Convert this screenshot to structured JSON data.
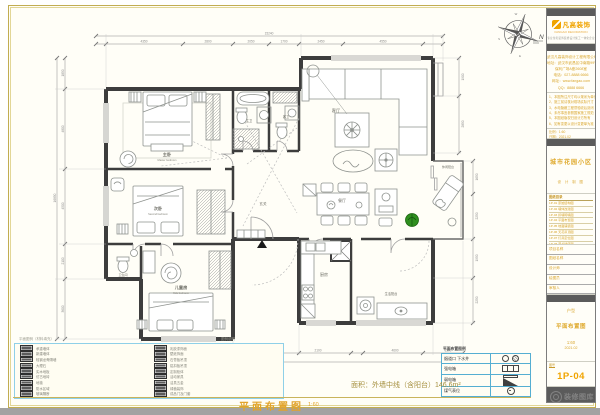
{
  "footer": {
    "title": "平面布置图",
    "scale": "1:60",
    "area": "面积：外墙中线（含阳台）146.6m²"
  },
  "north": "N",
  "compass_letters": {
    "top": "W",
    "left": "S",
    "bottom": "E"
  },
  "rooms": {
    "master_zh": "主卧",
    "master_en": "Master bedroom",
    "second_zh": "次卧",
    "second_en": "Second bedroom",
    "kids_zh": "儿童房",
    "kids_en": "Kids bedroom",
    "living": "客厅",
    "dining": "餐厅",
    "kitchen": "厨房",
    "hall": "玄关",
    "bath1": "主卫",
    "bath2": "客卫",
    "bath3": "卫生间",
    "laundry": "生活阳台",
    "balcony": "休闲阳台"
  },
  "dims": {
    "top": [
      "4350",
      "2800",
      "2050",
      "1700",
      "2450",
      "4550"
    ],
    "top_total": "15240",
    "left": [
      "1850",
      "4800",
      "4500",
      "2100",
      "3600"
    ],
    "left_total": "16850",
    "bottom": [
      "2250",
      "3600",
      "2500",
      "2100",
      "4600",
      "1500"
    ],
    "bottom_total": "17150",
    "right": [
      "1650",
      "2250",
      "1950",
      "2250"
    ],
    "right_upper": [
      "1900",
      "2850"
    ]
  },
  "titleblock": {
    "brand": "凡高装饰",
    "brand_sub": "FANGAO DECORATION",
    "brand_band": "专业住宅装饰装修设计施工一体化企业",
    "company_lines": [
      "武汉凡高装饰设计工程有限公司",
      "地址：武汉市武昌区中南路99号",
      "保利广场A座2608室",
      "电话：027-8888 6666",
      "网址：www.fangao.com",
      "QQ：8888 6666"
    ],
    "notes": [
      "1、本图所注尺寸均以毫米为单位",
      "2、施工前请核对现场实际尺寸",
      "3、水电隐蔽工程须验收后封闭",
      "4、未尽事宜参照国家施工规范",
      "5、本图纸版权归设计方所有",
      "6、如有变更以设计变更单为准"
    ],
    "meta": [
      "比例：1:60",
      "日期：2021.02"
    ],
    "project_name": "城市花园小区",
    "sign_row": "设 计 制 图",
    "index_title": "图纸目录",
    "index": [
      "1P-01 原始结构图",
      "1P-02 墙体改建图",
      "1P-03 拆墙砌墙图",
      "1P-04 平面布置图",
      "1P-05 地面铺装图",
      "1P-06 天花吊顶图",
      "1P-07 灯具定位图",
      "1P-08 开关插座图",
      "1P-09 水路走向图"
    ],
    "fields": [
      "项目名称",
      "图纸名称",
      "设计师",
      "绘图员",
      "审核人"
    ],
    "sheet_type": "户型",
    "sheet_name": "平面布置图",
    "scale": "1:60",
    "date": "2021.02",
    "no_label": "图号",
    "number": "1P-04"
  },
  "legend": {
    "header_left": "平面图例（材料填充）",
    "header_right": "图例说明",
    "col1": [
      "承重墙体",
      "新建墙体",
      "轻钢龙骨隔墙",
      "大理石",
      "实木地板",
      "仿古地砖",
      "地毯",
      "防水区域",
      "玻璃隔断"
    ],
    "col2": [
      "乳胶漆饰面",
      "壁纸饰面",
      "石膏板吊顶",
      "铝扣板吊顶",
      "定制柜体",
      "活动家具",
      "洁具五金",
      "绿植装饰",
      "成品门及门套"
    ]
  },
  "minitable": {
    "title": "平面布置图例",
    "rows": [
      {
        "label": "烟道口 下水井",
        "symbol": "circles"
      },
      {
        "label": "强电箱",
        "symbol": "rect"
      },
      {
        "label": "弱电箱",
        "symbol": "triangle"
      },
      {
        "label": "煤气表位",
        "symbol": "meter"
      }
    ]
  },
  "watermark": {
    "text": "装修图库"
  },
  "colors": {
    "accent_orange": "#f0a400",
    "accent_yellow": "#d9a62e",
    "table_blue": "#55aed2",
    "wall": "#3d3d3d",
    "plant_green": "#2f8f1f",
    "border_olive": "#c2ad52"
  }
}
